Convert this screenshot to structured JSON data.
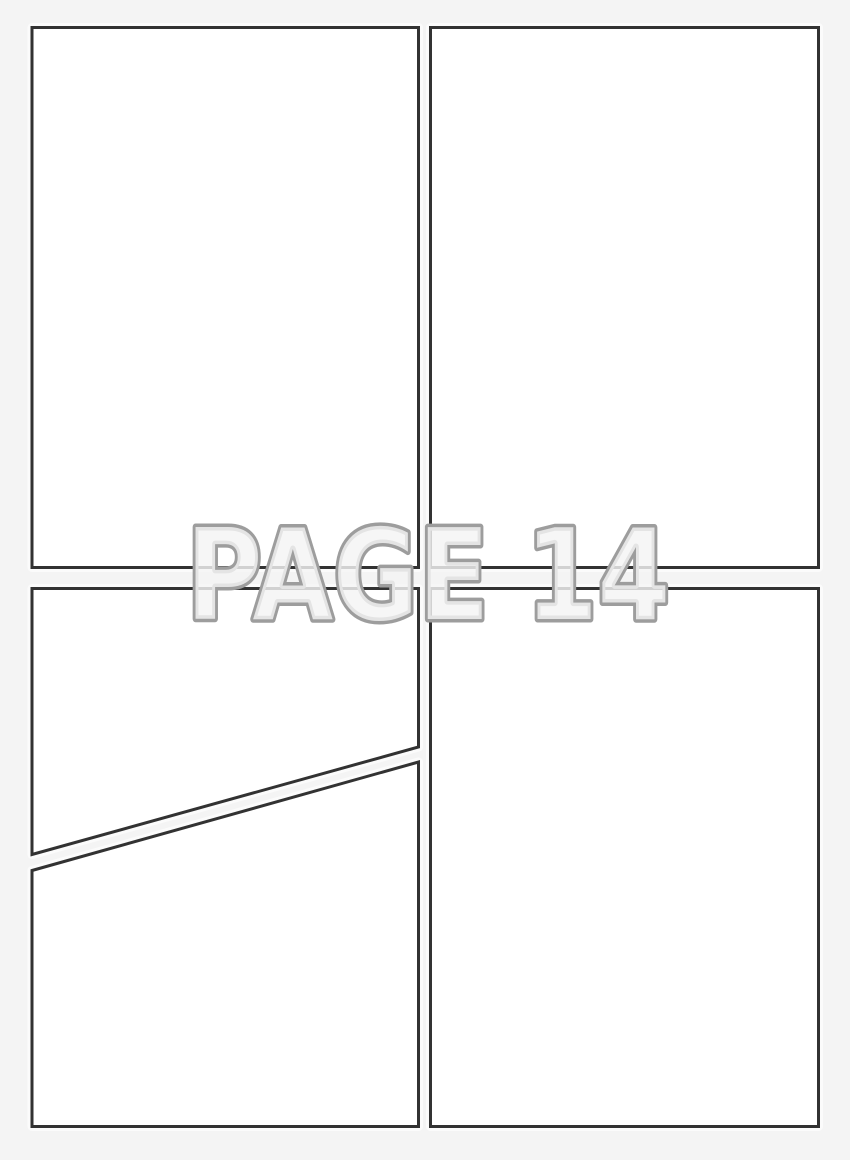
{
  "watermark": {
    "text": "PAGE 14",
    "fill": "rgba(244,244,244,0.82)",
    "stroke": "#9d9d9d"
  },
  "colors": {
    "background": "#f4f4f4",
    "panel_fill": "#ffffff",
    "panel_border": "#323232",
    "panel_halo": "#fbfbfb"
  },
  "panels": [
    {
      "name": "top-left",
      "shape": "rectangle"
    },
    {
      "name": "top-right",
      "shape": "rectangle"
    },
    {
      "name": "bottom-left-upper",
      "shape": "quadrilateral-diagonal-bottom"
    },
    {
      "name": "bottom-left-lower",
      "shape": "quadrilateral-diagonal-top"
    },
    {
      "name": "bottom-right",
      "shape": "rectangle"
    }
  ]
}
